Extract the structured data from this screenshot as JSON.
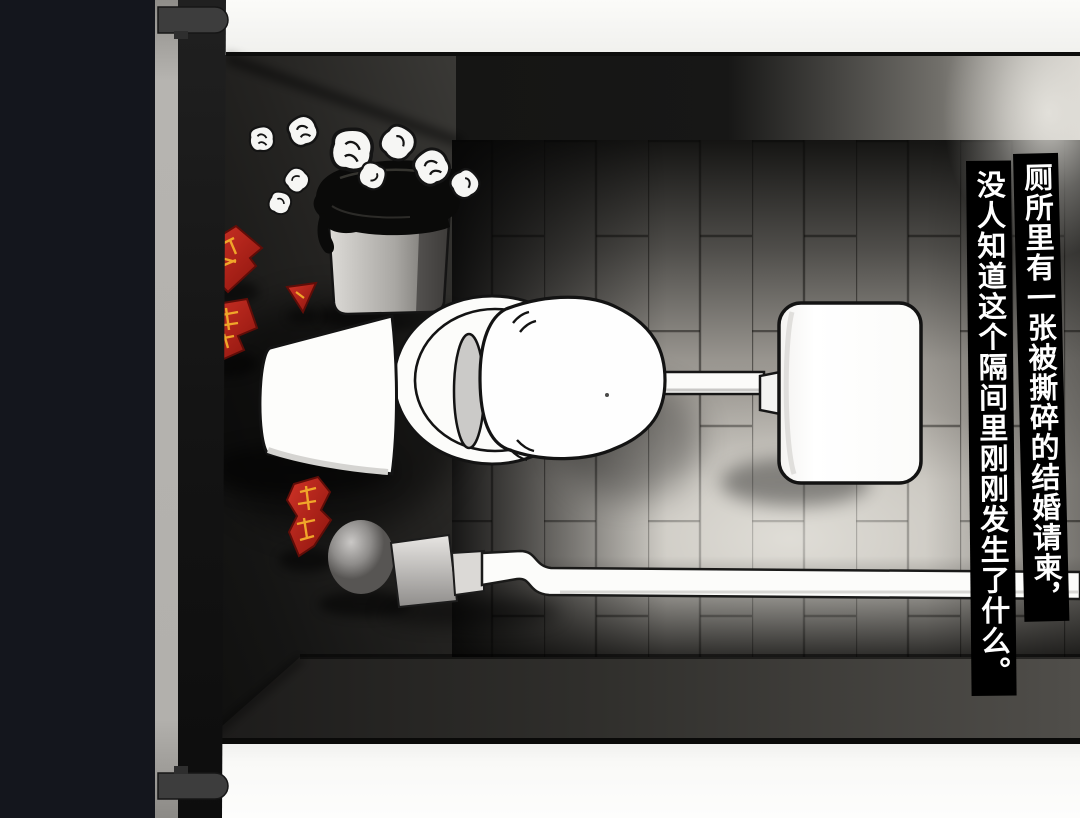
{
  "caption": {
    "line1": "厕所里有一张被撕碎的结婚请柬，",
    "line2": "没人知道这个隔间里刚刚发生了什么。"
  },
  "colors": {
    "caption_bg": "#000000",
    "caption_text": "#ffffff",
    "invitation_red": "#c92b20",
    "invitation_gold": "#f0a62a",
    "frame_bar_navy": "#14161d",
    "partition_gray": "#b4b2ae",
    "tile_light": "#d3d0ca",
    "wall_dark": "#1a1a18"
  }
}
